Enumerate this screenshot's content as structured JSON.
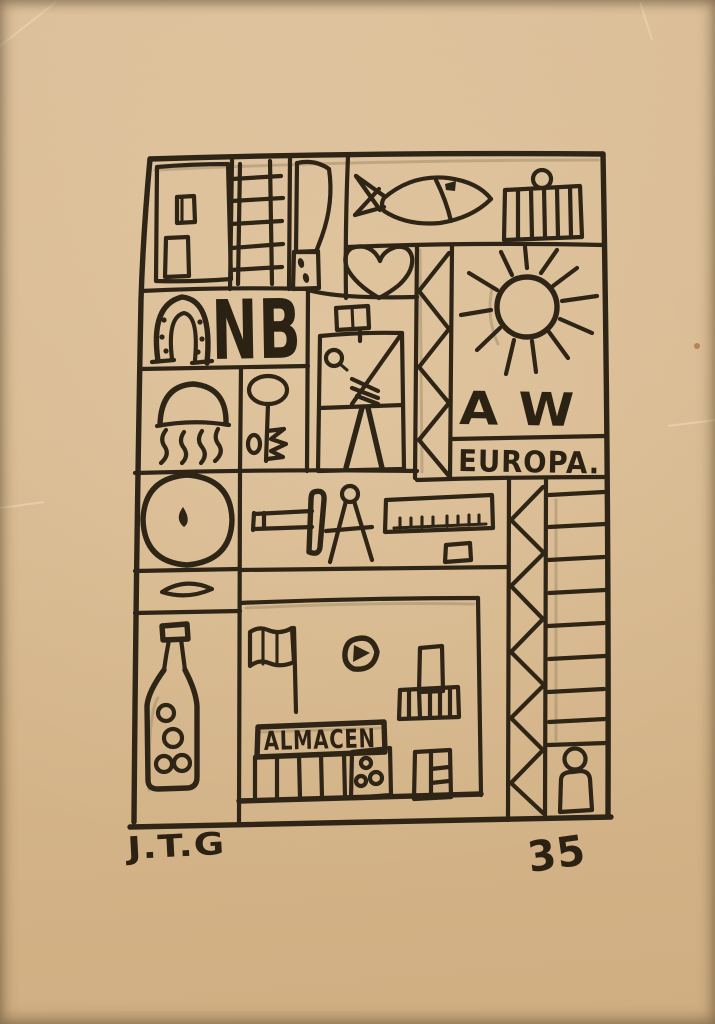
{
  "artwork": {
    "title": "Constructivist grid ink drawing on tan paper",
    "inscriptions": {
      "nb": "NB",
      "aw": "A W",
      "europa": "EUROPA.",
      "almacen": "ALMACEN",
      "signature": "J.T.G",
      "number": "35"
    },
    "colors": {
      "paper": "#d7b88e",
      "ink": "#2e2516",
      "pencil_underdrawing": "#93805f"
    },
    "symbols": [
      "door",
      "ladder",
      "knife",
      "fish",
      "grill",
      "heart",
      "horseshoe",
      "jellyfish",
      "key",
      "constructor-figure",
      "flag",
      "truss-zigzag",
      "sun",
      "wheel-circle",
      "hammer",
      "compass",
      "ruler",
      "lens",
      "bottle",
      "building",
      "building-flag",
      "moon",
      "basket",
      "almacen-sign",
      "colonnade",
      "door-with-dots",
      "panel-door",
      "zigzag-column",
      "ladder-column",
      "person"
    ]
  }
}
